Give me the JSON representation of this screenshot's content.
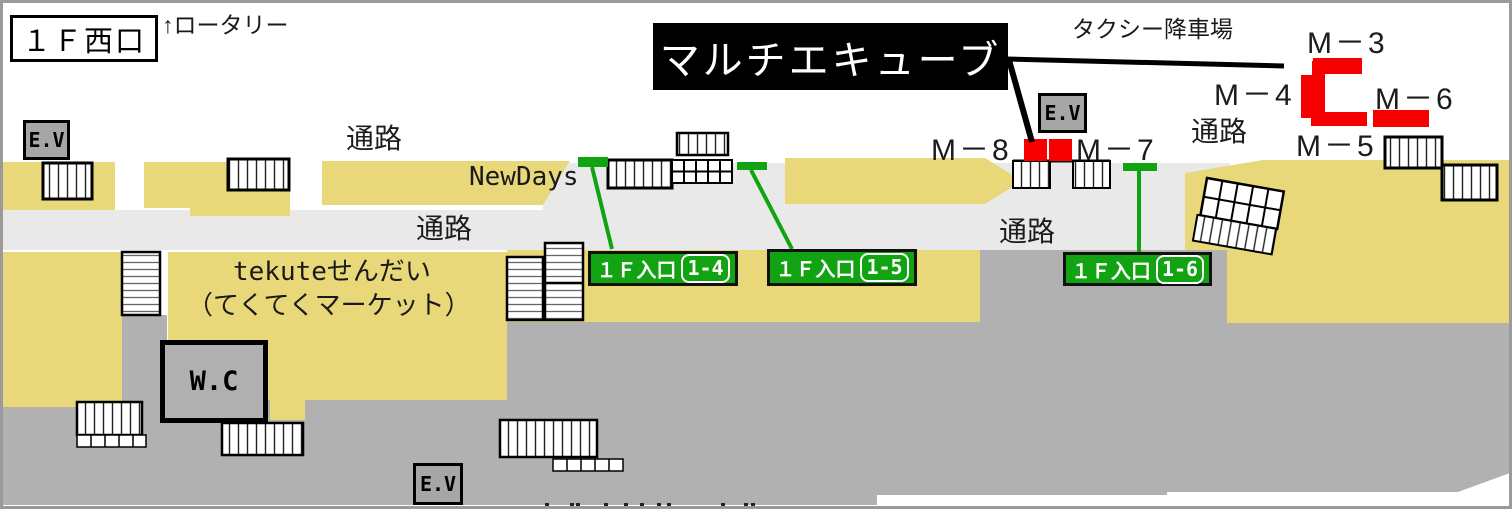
{
  "map": {
    "title": "１Ｆ西口",
    "rotary_note": "↑ロータリー",
    "banner": "マルチエキューブ",
    "taxi_label": "タクシー降車場",
    "corridor_label": "通路",
    "newdays": "NewDays",
    "tekute_line1": "tekuteせんだい",
    "tekute_line2": "（てくてくマーケット）",
    "wc_label": "W.C",
    "ev_label": "E.V",
    "m_labels": {
      "m3": "M－3",
      "m4": "M－4",
      "m5": "M－5",
      "m6": "M－6",
      "m7": "M－7",
      "m8": "M－8"
    },
    "entrances": [
      {
        "prefix": "１Ｆ入口",
        "number": "1-4"
      },
      {
        "prefix": "１Ｆ入口",
        "number": "1-5"
      },
      {
        "prefix": "１Ｆ入口",
        "number": "1-6"
      }
    ],
    "colors": {
      "shop_area": "#e8d87a",
      "corridor_area": "#e9e9e9",
      "track_area": "#b1b1b1",
      "unit_marker_red": "#f70000",
      "entrance_green": "#12a312",
      "banner_bg": "#000000",
      "border_gray": "#9a9a9a"
    }
  }
}
